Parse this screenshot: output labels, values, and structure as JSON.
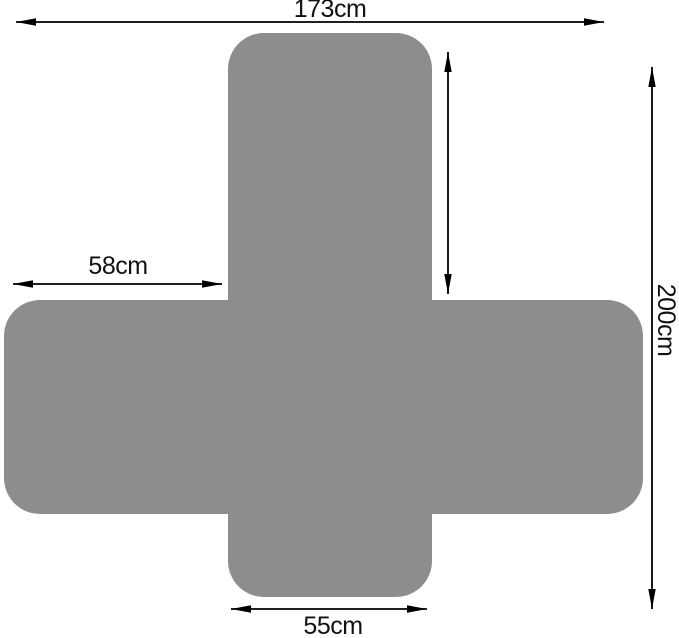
{
  "diagram": {
    "subject": "cross-shaped-cover-flat-layout",
    "colors": {
      "shape_fill": "#8d8d8d",
      "background": "#ffffff",
      "dimension_lines": "#000000",
      "label_text": "#111111"
    },
    "dimensions": {
      "top_width": {
        "label": "173cm"
      },
      "left_arm": {
        "label": "58cm"
      },
      "total_height": {
        "label": "200cm"
      },
      "bottom_flap": {
        "label": "55cm"
      },
      "backrest_height": {
        "label": ""
      }
    }
  }
}
